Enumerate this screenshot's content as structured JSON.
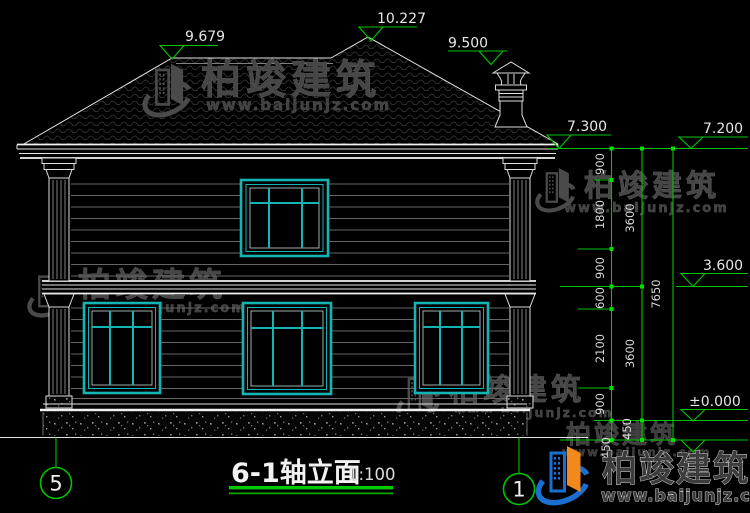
{
  "drawing": {
    "title": "6-1轴立面",
    "scale": "1:100",
    "axis_left": "5",
    "axis_right": "1"
  },
  "levels": {
    "left_ridge": "9.679",
    "main_ridge": "10.227",
    "chimney": "9.500",
    "eave_left": "7.300",
    "eave_right": "7.200",
    "second_floor": "3.600",
    "ground": "±0.000"
  },
  "dimensions": {
    "chain_inner": [
      "900",
      "1800",
      "900",
      "600",
      "2100",
      "900",
      "450"
    ],
    "chain_middle": [
      "3600",
      "3600",
      "450"
    ],
    "chain_total": [
      "7650"
    ]
  },
  "brand": {
    "name": "柏竣建筑",
    "url": "www.baijunjz.com"
  }
}
